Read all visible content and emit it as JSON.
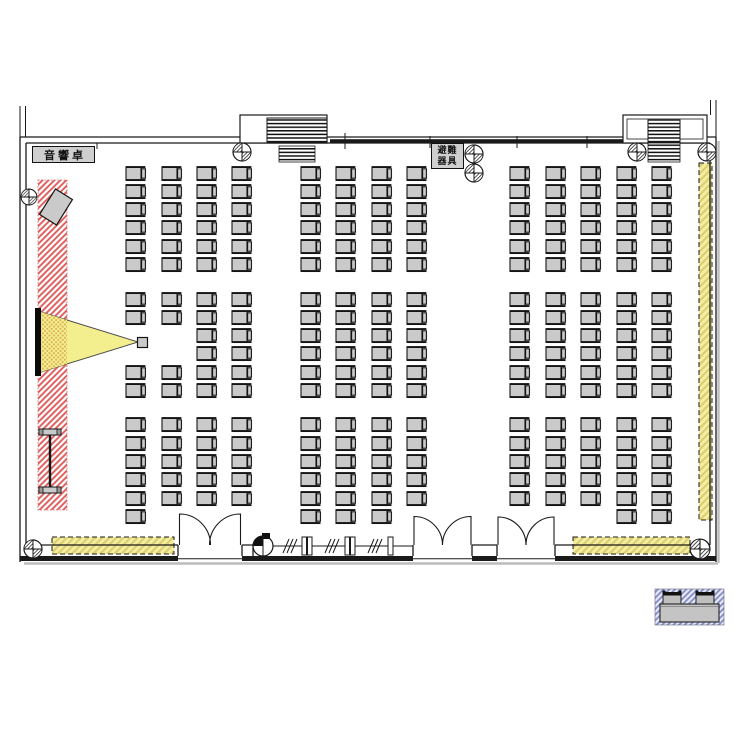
{
  "labels": {
    "sound_desk": "音響卓",
    "evac_line1": "避難",
    "evac_line2": "器具"
  },
  "palette": {
    "line": "#1a1a1a",
    "shadow": "#bcbcbc",
    "seat_fill": "#cacaca",
    "seat_edge": "#141414",
    "red_hatch": "#dc5a5a",
    "yellow_bg": "#f5efa3",
    "yellow_line": "#dbcf72",
    "blue_bg": "#e9e9f5",
    "blue_line": "#7d86c8",
    "beam_fill": "#f3ee8e",
    "beam_dot": "#d9a94e",
    "box_fill": "#cfcfcf",
    "screen": "#0a0a0a"
  },
  "seating": {
    "chair": {
      "w": 19,
      "h": 13
    },
    "groups": {
      "left": [
        126,
        162,
        197,
        232
      ],
      "center": [
        301,
        336,
        372,
        407
      ],
      "right": [
        510,
        546,
        581,
        617,
        652
      ]
    },
    "blocks": [
      {
        "name": "front",
        "rows": [
          167,
          185,
          203,
          221,
          240,
          258
        ],
        "groups": [
          {
            "group": "left"
          },
          {
            "group": "center"
          },
          {
            "group": "right"
          }
        ]
      },
      {
        "name": "middle",
        "rows": [
          293,
          311,
          329,
          347,
          366,
          384
        ],
        "groups": [
          {
            "group": "left",
            "omit": [
              {
                "col": 0,
                "rows": [
                  2,
                  3
                ]
              },
              {
                "col": 1,
                "rows": [
                  2,
                  3
                ]
              }
            ]
          },
          {
            "group": "center"
          },
          {
            "group": "right"
          }
        ]
      },
      {
        "name": "rear",
        "rows": [
          418,
          437,
          455,
          473,
          492,
          510
        ],
        "groups": [
          {
            "group": "left",
            "omit": [
              {
                "col": 1,
                "rows": [
                  5
                ]
              },
              {
                "col": 2,
                "rows": [
                  5
                ]
              },
              {
                "col": 3,
                "rows": [
                  5
                ]
              }
            ]
          },
          {
            "group": "center",
            "omit": [
              {
                "col": 3,
                "rows": [
                  5
                ]
              }
            ]
          },
          {
            "group": "right",
            "omit": [
              {
                "col": 0,
                "rows": [
                  5
                ]
              },
              {
                "col": 1,
                "rows": [
                  5
                ]
              },
              {
                "col": 2,
                "rows": [
                  5
                ]
              }
            ]
          }
        ]
      }
    ]
  }
}
